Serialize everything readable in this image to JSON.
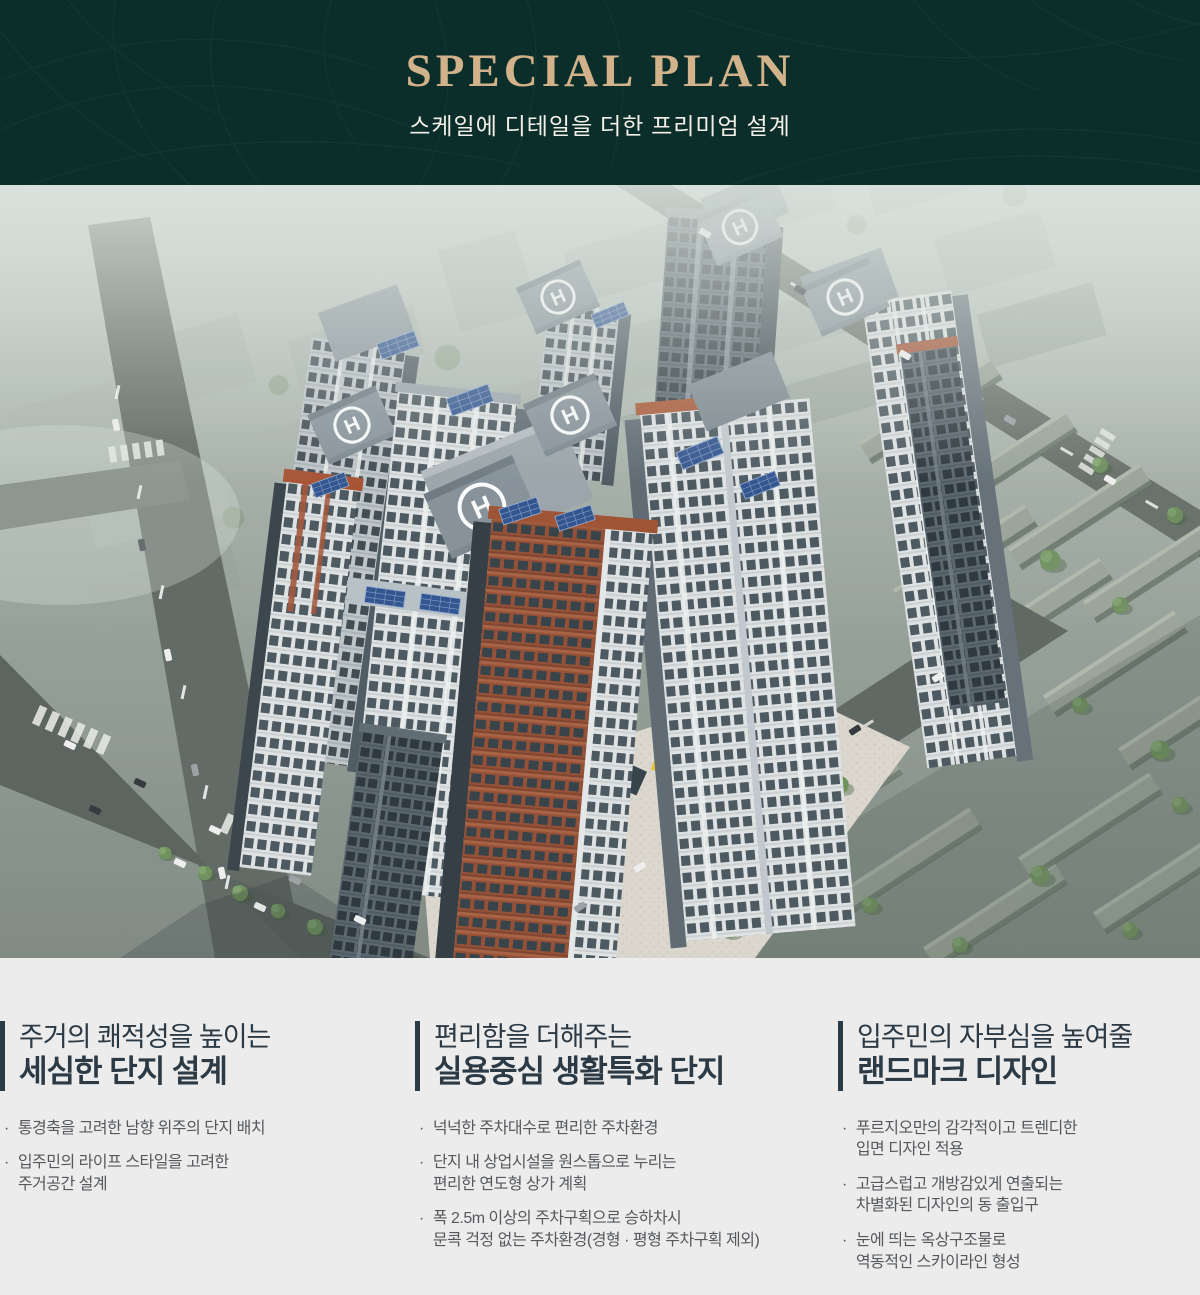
{
  "header": {
    "title": "SPECIAL PLAN",
    "subtitle": "스케일에 디테일을 더한 프리미엄 설계"
  },
  "hero": {
    "description": "프리미엄 아파트 단지 항공 조감도 렌더링",
    "helipad_letter": "H"
  },
  "features": {
    "bullet_char": "·",
    "columns": [
      {
        "title_line1": "주거의 쾌적성을 높이는",
        "title_line2": "세심한 단지 설계",
        "bullets": [
          {
            "lines": [
              "통경축을 고려한 남향 위주의 단지 배치"
            ]
          },
          {
            "lines": [
              "입주민의 라이프 스타일을 고려한",
              "주거공간 설계"
            ]
          }
        ]
      },
      {
        "title_line1": "편리함을 더해주는",
        "title_line2": "실용중심 생활특화 단지",
        "bullets": [
          {
            "lines": [
              "넉넉한 주차대수로 편리한 주차환경"
            ]
          },
          {
            "lines": [
              "단지 내 상업시설을 원스톱으로 누리는",
              "편리한 연도형 상가 계획"
            ]
          },
          {
            "lines": [
              "폭 2.5m 이상의 주차구획으로 승하차시",
              "문콕 걱정 없는 주차환경(경형 · 평형 주차구획 제외)"
            ]
          }
        ]
      },
      {
        "title_line1": "입주민의 자부심을 높여줄",
        "title_line2": "랜드마크 디자인",
        "bullets": [
          {
            "lines": [
              "푸르지오만의 감각적이고 트렌디한",
              "입면 디자인 적용"
            ]
          },
          {
            "lines": [
              "고급스럽고 개방감있게 연출되는",
              "차별화된 디자인의 동 출입구"
            ]
          },
          {
            "lines": [
              "눈에 띄는 옥상구조물로",
              "역동적인 스카이라인 형성"
            ]
          }
        ]
      }
    ]
  },
  "colors": {
    "header_bg": "#0c2e2a",
    "header_title": "#d2b28a",
    "header_subtitle": "#f2efe8",
    "footer_bg": "#ececec",
    "feature_title": "#2c3a45",
    "feature_text": "#55595d",
    "accent_terracotta": "#a24c2d",
    "solar_blue": "#2b4e8d"
  }
}
